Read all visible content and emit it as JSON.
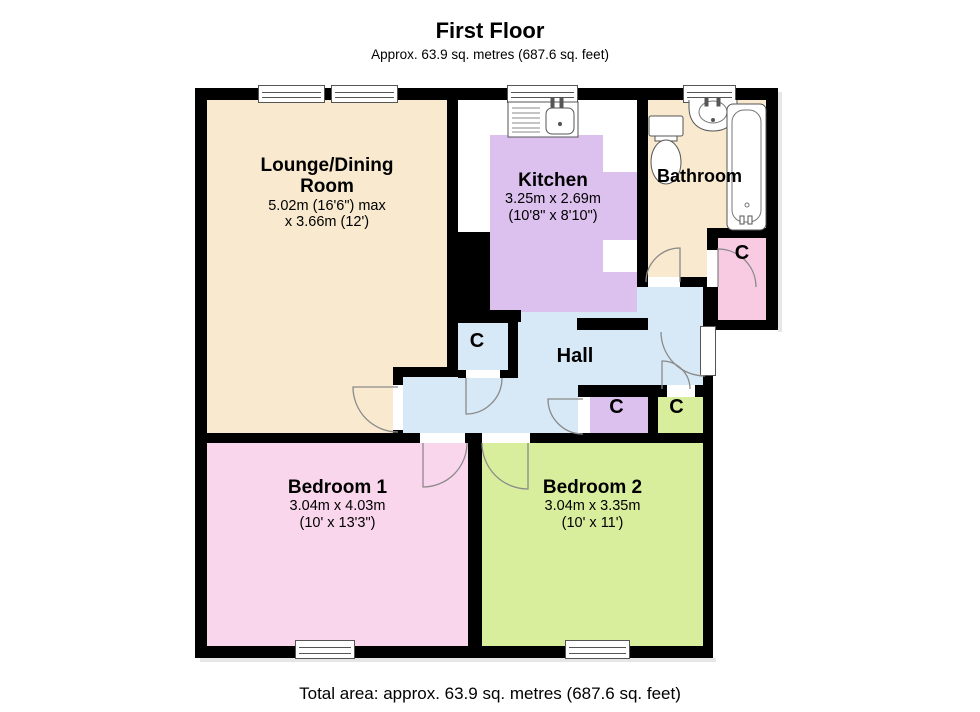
{
  "page": {
    "title": "First Floor",
    "subtitle": "Approx. 63.9 sq. metres (687.6 sq. feet)",
    "footer": "Total area: approx. 63.9 sq. metres (687.6 sq. feet)"
  },
  "rooms": {
    "lounge": {
      "name_line1": "Lounge/Dining",
      "name_line2": "Room",
      "dims_line1": "5.02m (16'6\") max",
      "dims_line2": "x 3.66m (12')",
      "floor_color": "#f8e9cf"
    },
    "kitchen": {
      "name": "Kitchen",
      "dims_line1": "3.25m x 2.69m",
      "dims_line2": "(10'8\" x 8'10\")",
      "floor_color": "#dcc0ee"
    },
    "bathroom": {
      "name": "Bathroom",
      "floor_color": "#f8e9cf"
    },
    "hall": {
      "name": "Hall",
      "floor_color": "#d7e8f6"
    },
    "bedroom1": {
      "name": "Bedroom 1",
      "dims_line1": "3.04m x 4.03m",
      "dims_line2": "(10' x 13'3\")",
      "floor_color": "#fad6ec"
    },
    "bedroom2": {
      "name": "Bedroom 2",
      "dims_line1": "3.04m x 3.35m",
      "dims_line2": "(10' x 11')",
      "floor_color": "#d9ee9c"
    }
  },
  "cupboards": {
    "hall_cupboard_label": "C",
    "inner_cupboard1_label": "C",
    "inner_cupboard2_label": "C",
    "external_cupboard_label": "C"
  },
  "palette": {
    "wall": "#000000",
    "door_arc": "#8a8a8a",
    "window_frame": "#555555",
    "fixture_outline": "#555555",
    "outside": "#ffffff"
  }
}
